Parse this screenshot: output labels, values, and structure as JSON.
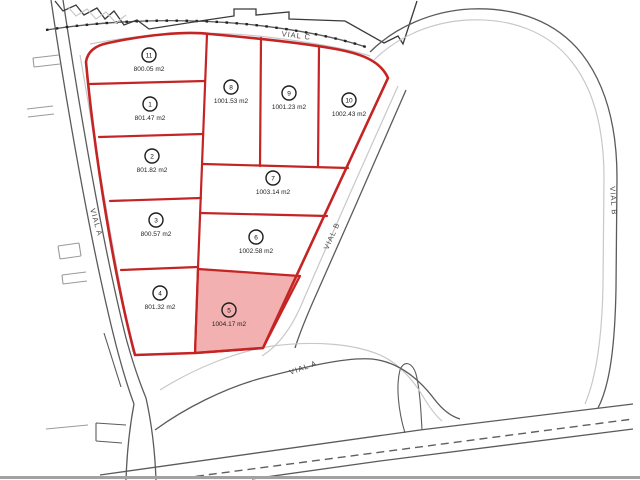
{
  "page": {
    "title": "Parcelacion - plano de parcelas"
  },
  "roads": {
    "vial_c": {
      "label": "VIAL C"
    },
    "vial_a_left": {
      "label": "VIAL A"
    },
    "vial_a_bottom": {
      "label": "VIAL A"
    },
    "vial_b_diag": {
      "label": "VIAL B"
    },
    "vial_b_right": {
      "label": "VIAL B"
    }
  },
  "parcels": [
    {
      "number": "1",
      "area": "801.47 m2",
      "highlighted": false
    },
    {
      "number": "2",
      "area": "801.82 m2",
      "highlighted": false
    },
    {
      "number": "3",
      "area": "800.57 m2",
      "highlighted": false
    },
    {
      "number": "4",
      "area": "801.32 m2",
      "highlighted": false
    },
    {
      "number": "5",
      "area": "1004.17 m2",
      "highlighted": true
    },
    {
      "number": "6",
      "area": "1002.58 m2",
      "highlighted": false
    },
    {
      "number": "7",
      "area": "1003.14 m2",
      "highlighted": false
    },
    {
      "number": "8",
      "area": "1001.53 m2",
      "highlighted": false
    },
    {
      "number": "9",
      "area": "1001.23 m2",
      "highlighted": false
    },
    {
      "number": "10",
      "area": "1002.43 m2",
      "highlighted": false
    },
    {
      "number": "11",
      "area": "800.05 m2",
      "highlighted": false
    }
  ],
  "colors": {
    "red": "#c42424",
    "pink": "#f2b0b0",
    "dark": "#5b5b5b",
    "black": "#3a3a3a",
    "mid": "#9a9a9a",
    "light": "#c8c8c8"
  }
}
